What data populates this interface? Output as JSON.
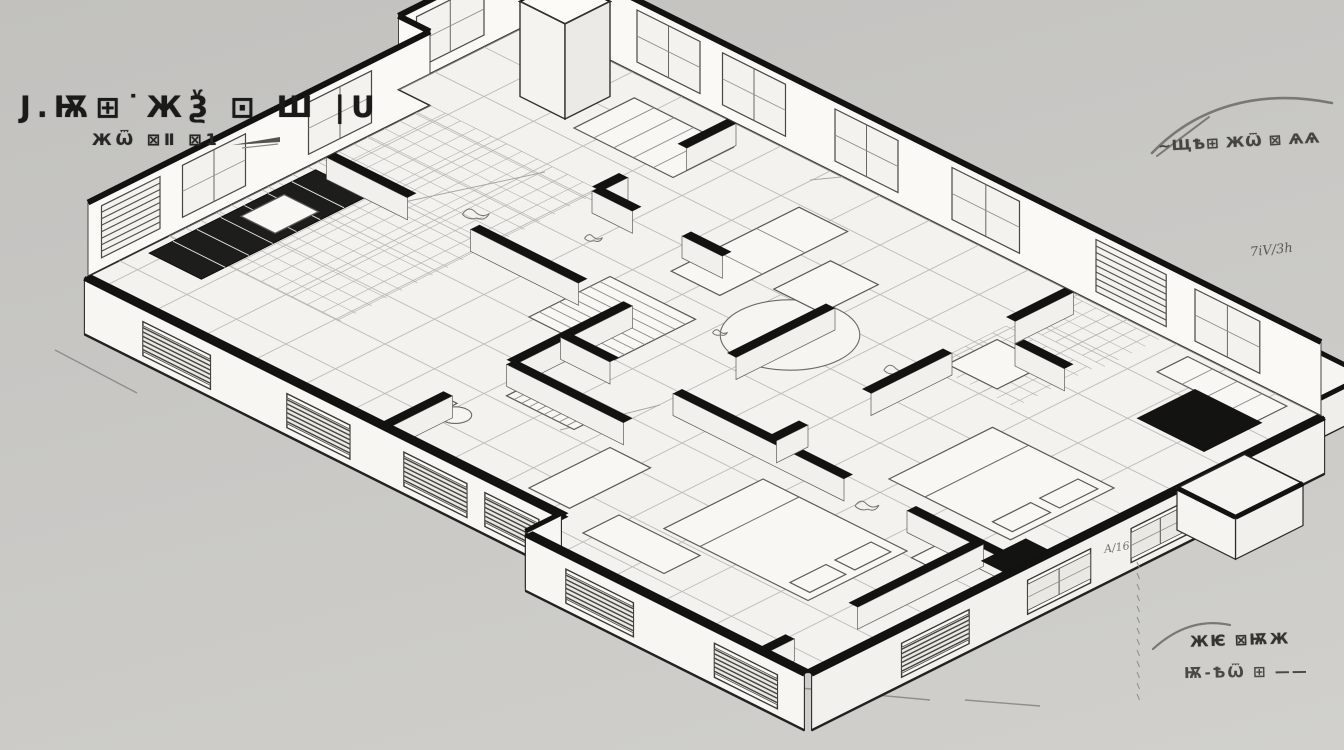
{
  "labels": {
    "title_line1": "J.Ѭ⊞˙ЖѮ ⊡ Ш |U",
    "title_line2": "ЖѾ ⊠Ⅱ ⊠1",
    "note_top_right": "∼ЩѢ⊞ ЖѾ ⊠ ѦѦ",
    "note_mid_right": "7iV/3h",
    "note_a16": "A/16",
    "note_bottom_right_1": "ЖѤ ⊠ѬЖ",
    "note_bottom_right_2": "Ѭ-ѢѾ ⊞ ——"
  },
  "colors": {
    "ink": "#121210",
    "floor": "#f3f2ef",
    "back_face": "#faf9f6",
    "front_face": "#f7f6f2",
    "right_face": "#f2f1ed",
    "inner_face": "#f1f0ec",
    "grid": "#bdbcb7",
    "fine_grid": "#b1b0ab",
    "sketch": "#5a5853",
    "soft": "#8f8e89"
  },
  "drawing": {
    "proj": {
      "x0": 565,
      "y0": 38,
      "cu": 0.9,
      "sv": 0.45
    },
    "floor": [
      [
        -35,
        0
      ],
      [
        840,
        0
      ],
      [
        840,
        570
      ],
      [
        530,
        570
      ],
      [
        530,
        530
      ],
      [
        0,
        530
      ],
      [
        0,
        150
      ],
      [
        -35,
        150
      ]
    ],
    "grid": {
      "step": 55,
      "u0": -35,
      "u1": 840,
      "v0": 0,
      "v1": 570
    },
    "fine_patches": [
      {
        "r": [
          0,
          150,
          190,
          440
        ],
        "step": 17
      },
      {
        "r": [
          565,
          5,
          665,
          65
        ],
        "step": 15
      },
      {
        "r": [
          565,
          75,
          660,
          160
        ],
        "step": 15
      }
    ],
    "back_walls": [
      {
        "dir": "v",
        "fixed": -35,
        "from": 0,
        "to": 150,
        "windows": [
          {
            "a": 55,
            "b": 130,
            "t": "glass"
          }
        ]
      },
      {
        "dir": "u",
        "fixed": 150,
        "from": -35,
        "to": 0,
        "windows": []
      },
      {
        "dir": "v",
        "fixed": 0,
        "from": 150,
        "to": 530,
        "windows": [
          {
            "a": 215,
            "b": 285,
            "t": "glass"
          },
          {
            "a": 355,
            "b": 425,
            "t": "glass"
          },
          {
            "a": 450,
            "b": 515,
            "t": "blinds"
          }
        ]
      },
      {
        "dir": "u",
        "fixed": 0,
        "from": -35,
        "to": 840,
        "windows": [
          {
            "a": 80,
            "b": 150,
            "t": "glass"
          },
          {
            "a": 175,
            "b": 245,
            "t": "glass"
          },
          {
            "a": 300,
            "b": 370,
            "t": "glass"
          },
          {
            "a": 430,
            "b": 505,
            "t": "glass"
          },
          {
            "a": 590,
            "b": 668,
            "t": "blinds"
          },
          {
            "a": 700,
            "b": 772,
            "t": "glass"
          }
        ]
      }
    ],
    "front_walls": [
      {
        "dir": "u",
        "fixed": 530,
        "from": 0,
        "to": 530,
        "side": 1,
        "face": "front_face",
        "windows": [
          {
            "a": 65,
            "b": 140,
            "t": "blinds"
          },
          {
            "a": 225,
            "b": 295,
            "t": "blinds"
          },
          {
            "a": 355,
            "b": 425,
            "t": "blinds"
          },
          {
            "a": 445,
            "b": 505,
            "t": "blinds"
          }
        ]
      },
      {
        "dir": "v",
        "fixed": 530,
        "from": 530,
        "to": 570,
        "side": -1,
        "face": "front_face",
        "windows": []
      },
      {
        "dir": "u",
        "fixed": 570,
        "from": 530,
        "to": 840,
        "side": 1,
        "face": "front_face",
        "windows": [
          {
            "a": 575,
            "b": 650,
            "t": "blinds"
          },
          {
            "a": 740,
            "b": 810,
            "t": "blinds"
          }
        ]
      },
      {
        "dir": "v",
        "fixed": 840,
        "from": 0,
        "to": 570,
        "side": 1,
        "face": "right_face",
        "windows": [
          {
            "a": 150,
            "b": 215,
            "t": "glass"
          },
          {
            "a": 260,
            "b": 330,
            "t": "glass"
          },
          {
            "a": 395,
            "b": 470,
            "t": "blinds"
          }
        ]
      }
    ],
    "inner_walls": [
      {
        "dir": "u",
        "fixed": 260,
        "from": 0,
        "to": 280,
        "gaps": [
          [
            90,
            160
          ]
        ]
      },
      {
        "dir": "v",
        "fixed": 330,
        "from": 260,
        "to": 530,
        "gaps": [
          [
            390,
            460
          ]
        ]
      },
      {
        "dir": "v",
        "fixed": 185,
        "from": 0,
        "to": 150,
        "gaps": [
          [
            55,
            120
          ]
        ]
      },
      {
        "dir": "u",
        "fixed": 150,
        "from": 185,
        "to": 330,
        "gaps": [
          [
            230,
            285
          ]
        ]
      },
      {
        "dir": "u",
        "fixed": 330,
        "from": 330,
        "to": 840,
        "gaps": [
          [
            385,
            455
          ],
          [
            645,
            715
          ]
        ]
      },
      {
        "dir": "v",
        "fixed": 560,
        "from": 0,
        "to": 330,
        "gaps": [
          [
            65,
            135
          ],
          [
            225,
            295
          ]
        ]
      },
      {
        "dir": "v",
        "fixed": 790,
        "from": 330,
        "to": 570,
        "gaps": [
          [
            470,
            540
          ]
        ]
      },
      {
        "dir": "v",
        "fixed": 445,
        "from": 150,
        "to": 260,
        "gaps": []
      },
      {
        "dir": "u",
        "fixed": 390,
        "from": 330,
        "to": 460,
        "gaps": []
      },
      {
        "dir": "u",
        "fixed": 85,
        "from": 590,
        "to": 645,
        "gaps": []
      }
    ],
    "furniture": [
      {
        "t": "ellipse",
        "c": [
          455,
          205
        ],
        "r": 55,
        "name": "rug"
      },
      {
        "t": "rect",
        "r": [
          8,
          285,
          66,
          470
        ],
        "fill": "dark",
        "stripes": "u",
        "n": 7,
        "name": "kitchen-counter"
      },
      {
        "t": "rect",
        "r": [
          18,
          330,
          56,
          378
        ],
        "fill": "light",
        "name": "kitchen-sink"
      },
      {
        "t": "rect",
        "r": [
          290,
          240,
          385,
          330
        ],
        "fill": "light",
        "stripes": "u",
        "n": 8,
        "name": "island"
      },
      {
        "t": "rect",
        "r": [
          105,
          28,
          215,
          95
        ],
        "fill": "light",
        "stripes": "v",
        "n": 5,
        "name": "counter2"
      },
      {
        "t": "rect",
        "r": [
          318,
          58,
          372,
          200
        ],
        "fill": "light",
        "stripes": "u",
        "n": 3,
        "name": "sofa"
      },
      {
        "t": "rect",
        "r": [
          395,
          100,
          448,
          163
        ],
        "fill": "light",
        "name": "coffee-table"
      },
      {
        "t": "bed",
        "r": [
          600,
          380,
          760,
          490
        ],
        "name": "bed-1"
      },
      {
        "t": "bed",
        "r": [
          670,
          195,
          805,
          310
        ],
        "name": "bed-2"
      },
      {
        "t": "rect",
        "r": [
          700,
          8,
          810,
          42
        ],
        "fill": "light",
        "stripes": "v",
        "n": 4,
        "name": "wardrobe"
      },
      {
        "t": "rect",
        "r": [
          575,
          95,
          630,
          150
        ],
        "fill": "light",
        "name": "desk"
      },
      {
        "t": "rect",
        "r": [
          365,
          390,
          440,
          430
        ],
        "fill": "light",
        "stripes": "v",
        "n": 9,
        "name": "striped-mat"
      },
      {
        "t": "rect",
        "r": [
          480,
          430,
          525,
          520
        ],
        "fill": "light",
        "name": "vanity"
      },
      {
        "t": "rect",
        "r": [
          560,
          500,
          650,
          540
        ],
        "fill": "light",
        "name": "bench"
      },
      {
        "t": "rect",
        "r": [
          770,
          350,
          808,
          385
        ],
        "fill": "light",
        "name": "nightstand"
      },
      {
        "t": "rect",
        "r": [
          332,
          466,
          346,
          494
        ],
        "fill": "light",
        "name": "toilet-tank"
      },
      {
        "t": "ellipse",
        "c": [
          358,
          480
        ],
        "r": 13,
        "name": "toilet"
      }
    ],
    "boxes_up": [
      {
        "r": [
          40,
          40,
          90,
          90
        ],
        "h": 95,
        "name": "tall-cabinet"
      }
    ],
    "black_slabs": [
      [
        740,
        40,
        815,
        105
      ],
      [
        812,
        300,
        845,
        350
      ]
    ],
    "back_porch": {
      "r": [
        740,
        -70,
        820,
        0
      ],
      "h": 40
    },
    "front_porch": {
      "r": [
        840,
        85,
        905,
        160
      ],
      "h": 42
    },
    "scribbles": [
      [
        149,
        243,
        18
      ],
      [
        555,
        183,
        16
      ],
      [
        577,
        27,
        13
      ],
      [
        690,
        350,
        16
      ],
      [
        240,
        205,
        12
      ],
      [
        415,
        240,
        10
      ]
    ],
    "guides": [
      [
        390,
        205,
        545,
        172
      ],
      [
        810,
        180,
        935,
        168
      ],
      [
        560,
        430,
        660,
        405
      ]
    ],
    "ground_lines": [
      [
        55,
        350,
        137,
        393
      ],
      [
        262,
        418,
        305,
        440
      ],
      [
        800,
        688,
        930,
        700
      ],
      [
        965,
        700,
        1040,
        706
      ]
    ],
    "swooshes": [
      {
        "d": "M 1152 153 C 1195 108 1258 88 1332 103",
        "w": 2.6
      },
      {
        "d": "M 1157 156 L 1209 117",
        "w": 2
      },
      {
        "d": "M 1153 649 C 1176 628 1202 619 1230 625",
        "w": 2.2
      }
    ],
    "nib": {
      "poly": "232,145 280,137 280,142",
      "line": [
        242,
        148,
        278,
        144
      ]
    },
    "tick_column": {
      "x": 1137,
      "y1": 562,
      "y2": 696,
      "step": 11
    }
  }
}
